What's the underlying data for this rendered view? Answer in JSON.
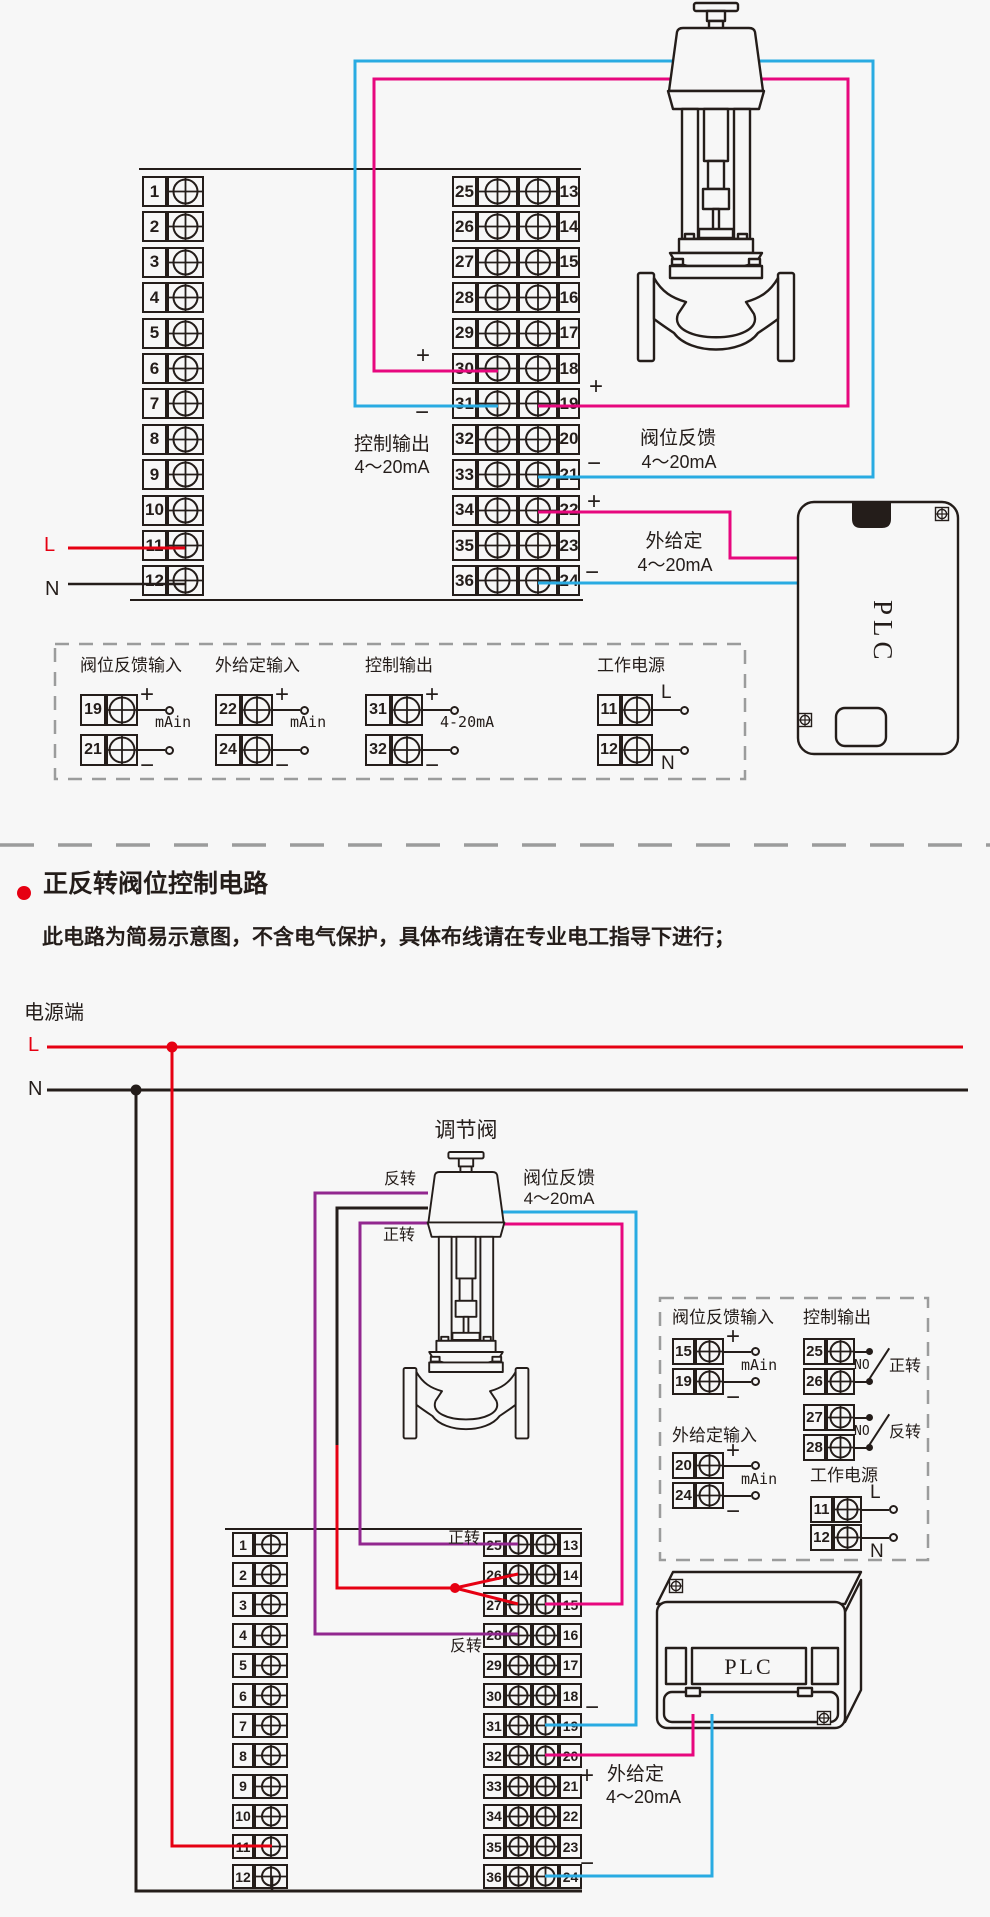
{
  "colors": {
    "pink": "#e7077e",
    "blue": "#29abe2",
    "red": "#e60012",
    "purple": "#92278f",
    "ink": "#241d1a",
    "dash": "#9b9c9c",
    "bg": "#f7f7f7"
  },
  "shared": {
    "plus": "+",
    "minus": "−",
    "mA_in": "mAin",
    "range_legend": "4-20mA",
    "range": "4～20mA",
    "L": "L",
    "N": "N",
    "NO": "NO",
    "plc": "PLC"
  },
  "section1": {
    "left_terminals": [
      "1",
      "2",
      "3",
      "4",
      "5",
      "6",
      "7",
      "8",
      "9",
      "10",
      "11",
      "12"
    ],
    "mid_left": [
      "25",
      "26",
      "27",
      "28",
      "29",
      "30",
      "31",
      "32",
      "33",
      "34",
      "35",
      "36"
    ],
    "mid_right": [
      "13",
      "14",
      "15",
      "16",
      "17",
      "18",
      "19",
      "20",
      "21",
      "22",
      "23",
      "24"
    ],
    "ctrl_out": [
      "控制输出",
      "4～20mA"
    ],
    "valve_fb": [
      "阀位反馈",
      "4～20mA"
    ],
    "ext_sp": [
      "外给定",
      "4～20mA"
    ],
    "legend": {
      "fb": {
        "title": "阀位反馈输入",
        "t1": "19",
        "t2": "21",
        "s1": "+",
        "s2": "−",
        "mid": "mAin"
      },
      "ext": {
        "title": "外给定输入",
        "t1": "22",
        "t2": "24",
        "s1": "+",
        "s2": "−",
        "mid": "mAin"
      },
      "out": {
        "title": "控制输出",
        "t1": "31",
        "t2": "32",
        "s1": "+",
        "s2": "−",
        "mid": "4-20mA"
      },
      "pwr": {
        "title": "工作电源",
        "t1": "11",
        "t2": "12",
        "s1": "L",
        "s2": "N",
        "mid": ""
      }
    }
  },
  "section2": {
    "title": "正反转阀位控制电路",
    "subtitle": "此电路为简易示意图，不含电气保护，具体布线请在专业电工指导下进行；",
    "power": "电源端",
    "valve": "调节阀",
    "fwd": "正转",
    "rev": "反转",
    "valve_fb": [
      "阀位反馈",
      "4～20mA"
    ],
    "ext_sp": [
      "外给定",
      "4～20mA"
    ],
    "left_terminals": [
      "1",
      "2",
      "3",
      "4",
      "5",
      "6",
      "7",
      "8",
      "9",
      "10",
      "11",
      "12"
    ],
    "mid_left": [
      "25",
      "26",
      "27",
      "28",
      "29",
      "30",
      "31",
      "32",
      "33",
      "34",
      "35",
      "36"
    ],
    "mid_right": [
      "13",
      "14",
      "15",
      "16",
      "17",
      "18",
      "19",
      "20",
      "21",
      "22",
      "23",
      "24"
    ],
    "legend": {
      "fb": {
        "title": "阀位反馈输入",
        "t1": "15",
        "t2": "19",
        "s1": "+",
        "s2": "−",
        "mid": "mAin"
      },
      "ext": {
        "title": "外给定输入",
        "t1": "20",
        "t2": "24",
        "s1": "+",
        "s2": "−",
        "mid": "mAin"
      },
      "out": {
        "title": "控制输出",
        "pairs": [
          {
            "t1": "25",
            "t2": "26",
            "no": "NO",
            "dir": "正转"
          },
          {
            "t1": "27",
            "t2": "28",
            "no": "NO",
            "dir": "反转"
          }
        ]
      },
      "pwr": {
        "title": "工作电源",
        "t1": "11",
        "t2": "12",
        "s1": "L",
        "s2": "N"
      }
    }
  }
}
